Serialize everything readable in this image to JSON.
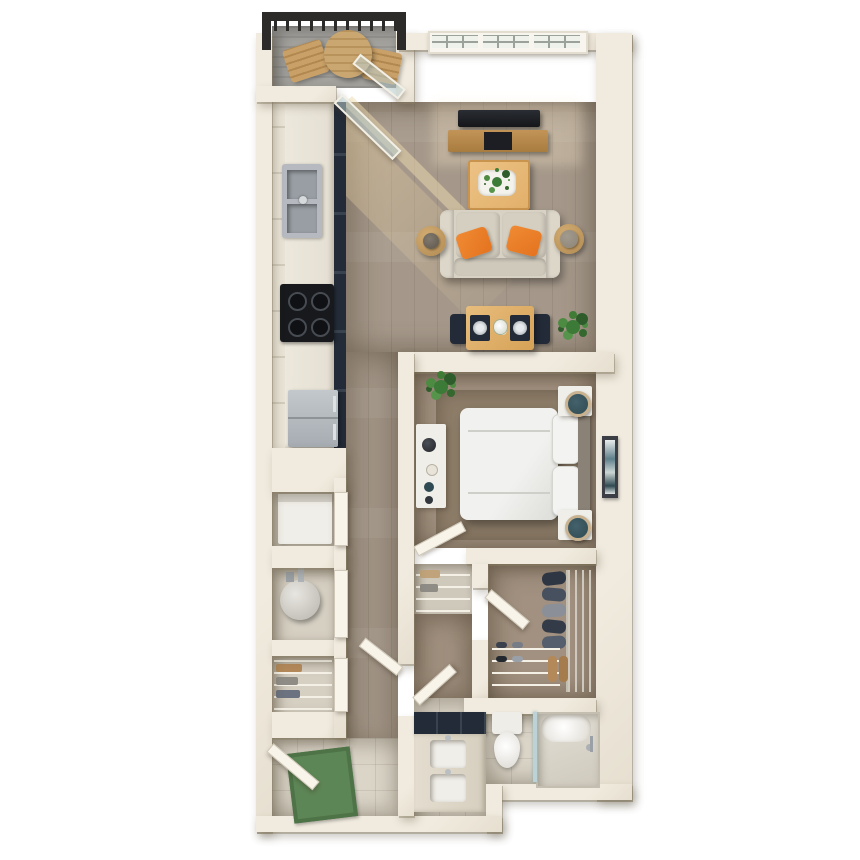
{
  "scene": {
    "type": "3d-rendered-floor-plan",
    "description": "top-down 3D floor plan of a one-bedroom apartment with balcony",
    "width": 860,
    "height": 860
  },
  "palette": {
    "bg": "#ffffff",
    "wall": "#f1ebdf",
    "wood": "#a5988a",
    "carpet": "#a29180",
    "rug": "#8d7d69",
    "closetfloor": "#d6d0c3",
    "tile": "#dbd5c8",
    "balconyfloor": "#a5a39e",
    "rail": "#2c2b29",
    "navy": "#232b38",
    "black": "#17191d",
    "oak": "#e2b06a",
    "oakdark": "#c9944d",
    "sofa": "#d8d2c4",
    "orange": "#e4731f",
    "whitefurn": "#f0eee8",
    "teal": "#2f4a52",
    "mat": "#5d8656",
    "green": "#3c7a38",
    "glass": "rgba(186,206,206,0.55)",
    "steel": "#b4b9bd",
    "sun": "rgba(236,212,164,0.45)"
  },
  "rooms": [
    {
      "name": "balcony",
      "items": [
        "railing",
        "round-outdoor-table",
        "lounge-chair",
        "lounge-chair"
      ]
    },
    {
      "name": "living-room",
      "items": [
        "gridded-window",
        "tv",
        "media-console",
        "coffee-table",
        "tray-with-plant",
        "sofa",
        "orange-throw-pillow",
        "orange-throw-pillow",
        "round-side-table-with-lamp",
        "round-side-table-with-lamp"
      ]
    },
    {
      "name": "dining-area",
      "items": [
        "wood-dining-table",
        "navy-dining-chair",
        "navy-dining-chair",
        "place-setting",
        "place-setting",
        "flower-centerpiece",
        "potted-plant"
      ]
    },
    {
      "name": "kitchen",
      "items": [
        "upper-cabinets",
        "light-countertop",
        "navy-base-cabinets",
        "double-basin-sink",
        "cooktop",
        "refrigerator"
      ]
    },
    {
      "name": "bedroom",
      "items": [
        "bed",
        "pillow",
        "pillow",
        "headboard",
        "nightstand-with-lamp",
        "nightstand-with-lamp",
        "dresser-with-decor",
        "area-rug",
        "potted-plant",
        "wall-art"
      ]
    },
    {
      "name": "walk-in-closet",
      "items": [
        "wire-shelving",
        "hanging-clothes",
        "shoe-rack",
        "boots",
        "door"
      ]
    },
    {
      "name": "linen-closet",
      "items": [
        "shelves",
        "folded-linens"
      ]
    },
    {
      "name": "laundry-closet",
      "items": [
        "washer-dryer",
        "door"
      ]
    },
    {
      "name": "utility-closet",
      "items": [
        "water-heater",
        "door"
      ]
    },
    {
      "name": "coat-closet",
      "items": [
        "wire-shelves",
        "folded-items",
        "door"
      ]
    },
    {
      "name": "bathroom",
      "items": [
        "vanity-navy-cabinets",
        "sink",
        "sink",
        "toilet",
        "shower-with-glass-panel"
      ]
    },
    {
      "name": "entry",
      "items": [
        "entry-door",
        "green-doormat",
        "tile-floor"
      ]
    }
  ]
}
